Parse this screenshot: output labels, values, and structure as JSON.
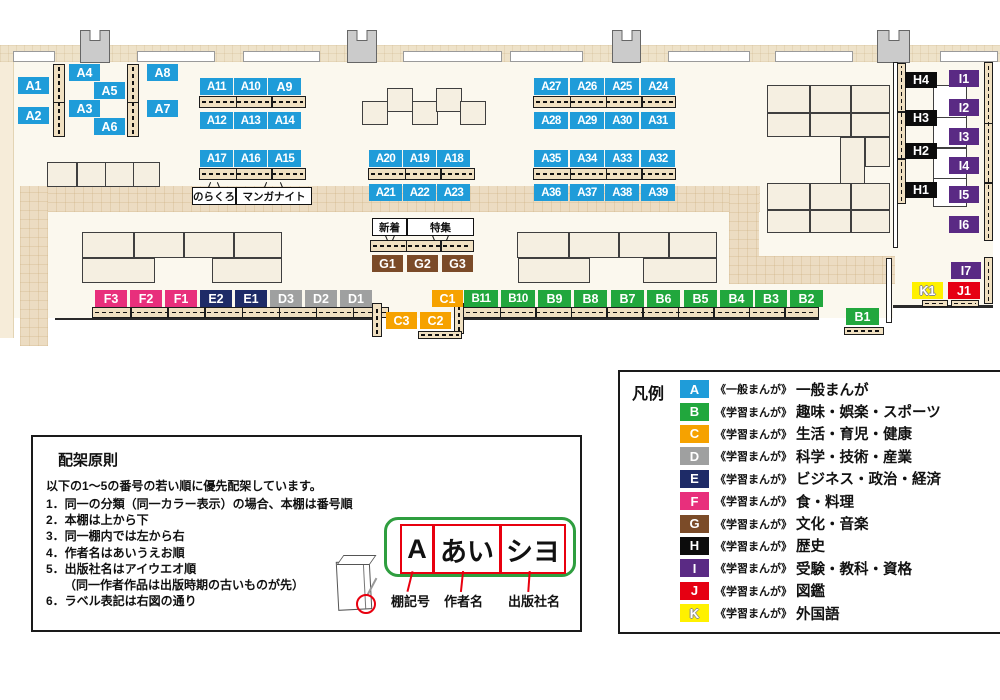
{
  "map": {
    "marker_colors": {
      "A": "#1f9cd9",
      "B": "#21a73d",
      "C": "#f6a200",
      "D": "#9fa0a0",
      "E": "#1e2b67",
      "F": "#e82f7c",
      "G": "#7b4b28",
      "H": "#0c0c0c",
      "I": "#5a2a84",
      "J": "#e60012",
      "K": "#fff100"
    },
    "markers": [
      {
        "code": "A1",
        "x": 18,
        "y": 77
      },
      {
        "code": "A2",
        "x": 18,
        "y": 107
      },
      {
        "code": "A4",
        "x": 69,
        "y": 64
      },
      {
        "code": "A3",
        "x": 69,
        "y": 100
      },
      {
        "code": "A5",
        "x": 94,
        "y": 82
      },
      {
        "code": "A6",
        "x": 94,
        "y": 118
      },
      {
        "code": "A8",
        "x": 147,
        "y": 64
      },
      {
        "code": "A7",
        "x": 147,
        "y": 100
      },
      {
        "code": "A11",
        "x": 200,
        "y": 78,
        "w": 33
      },
      {
        "code": "A10",
        "x": 234,
        "y": 78,
        "w": 33
      },
      {
        "code": "A9",
        "x": 268,
        "y": 78,
        "w": 33
      },
      {
        "code": "A12",
        "x": 200,
        "y": 112,
        "w": 33
      },
      {
        "code": "A13",
        "x": 234,
        "y": 112,
        "w": 33
      },
      {
        "code": "A14",
        "x": 268,
        "y": 112,
        "w": 33
      },
      {
        "code": "A17",
        "x": 200,
        "y": 150,
        "w": 33
      },
      {
        "code": "A16",
        "x": 234,
        "y": 150,
        "w": 33
      },
      {
        "code": "A15",
        "x": 268,
        "y": 150,
        "w": 33
      },
      {
        "code": "A20",
        "x": 369,
        "y": 150,
        "w": 33
      },
      {
        "code": "A19",
        "x": 403,
        "y": 150,
        "w": 33
      },
      {
        "code": "A18",
        "x": 437,
        "y": 150,
        "w": 33
      },
      {
        "code": "A21",
        "x": 369,
        "y": 184,
        "w": 33
      },
      {
        "code": "A22",
        "x": 403,
        "y": 184,
        "w": 33
      },
      {
        "code": "A23",
        "x": 437,
        "y": 184,
        "w": 33
      },
      {
        "code": "A27",
        "x": 534,
        "y": 78,
        "w": 34
      },
      {
        "code": "A26",
        "x": 570,
        "y": 78,
        "w": 34
      },
      {
        "code": "A25",
        "x": 605,
        "y": 78,
        "w": 34
      },
      {
        "code": "A24",
        "x": 641,
        "y": 78,
        "w": 34
      },
      {
        "code": "A28",
        "x": 534,
        "y": 112,
        "w": 34
      },
      {
        "code": "A29",
        "x": 570,
        "y": 112,
        "w": 34
      },
      {
        "code": "A30",
        "x": 605,
        "y": 112,
        "w": 34
      },
      {
        "code": "A31",
        "x": 641,
        "y": 112,
        "w": 34
      },
      {
        "code": "A35",
        "x": 534,
        "y": 150,
        "w": 34
      },
      {
        "code": "A34",
        "x": 570,
        "y": 150,
        "w": 34
      },
      {
        "code": "A33",
        "x": 605,
        "y": 150,
        "w": 34
      },
      {
        "code": "A32",
        "x": 641,
        "y": 150,
        "w": 34
      },
      {
        "code": "A36",
        "x": 534,
        "y": 184,
        "w": 34
      },
      {
        "code": "A37",
        "x": 570,
        "y": 184,
        "w": 34
      },
      {
        "code": "A38",
        "x": 605,
        "y": 184,
        "w": 34
      },
      {
        "code": "A39",
        "x": 641,
        "y": 184,
        "w": 34
      },
      {
        "code": "G1",
        "x": 372,
        "y": 255
      },
      {
        "code": "G2",
        "x": 407,
        "y": 255
      },
      {
        "code": "G3",
        "x": 442,
        "y": 255
      },
      {
        "code": "F3",
        "x": 95,
        "y": 290,
        "w": 32
      },
      {
        "code": "F2",
        "x": 130,
        "y": 290,
        "w": 32
      },
      {
        "code": "F1",
        "x": 165,
        "y": 290,
        "w": 32
      },
      {
        "code": "E2",
        "x": 200,
        "y": 290,
        "w": 32
      },
      {
        "code": "E1",
        "x": 235,
        "y": 290,
        "w": 32
      },
      {
        "code": "D3",
        "x": 270,
        "y": 290,
        "w": 32
      },
      {
        "code": "D2",
        "x": 305,
        "y": 290,
        "w": 32
      },
      {
        "code": "D1",
        "x": 340,
        "y": 290,
        "w": 32
      },
      {
        "code": "C1",
        "x": 432,
        "y": 290
      },
      {
        "code": "C3",
        "x": 386,
        "y": 312
      },
      {
        "code": "C2",
        "x": 420,
        "y": 312
      },
      {
        "code": "B11",
        "x": 464,
        "y": 290,
        "w": 34
      },
      {
        "code": "B10",
        "x": 501,
        "y": 290,
        "w": 34
      },
      {
        "code": "B9",
        "x": 538,
        "y": 290,
        "w": 33
      },
      {
        "code": "B8",
        "x": 574,
        "y": 290,
        "w": 33
      },
      {
        "code": "B7",
        "x": 611,
        "y": 290,
        "w": 33
      },
      {
        "code": "B6",
        "x": 647,
        "y": 290,
        "w": 33
      },
      {
        "code": "B5",
        "x": 684,
        "y": 290,
        "w": 33
      },
      {
        "code": "B4",
        "x": 720,
        "y": 290,
        "w": 33
      },
      {
        "code": "B3",
        "x": 755,
        "y": 290,
        "w": 32
      },
      {
        "code": "B2",
        "x": 790,
        "y": 290,
        "w": 33
      },
      {
        "code": "B1",
        "x": 846,
        "y": 308,
        "w": 33
      },
      {
        "code": "H4",
        "x": 905,
        "y": 72,
        "w": 32,
        "h": 16
      },
      {
        "code": "H3",
        "x": 905,
        "y": 110,
        "w": 32,
        "h": 16
      },
      {
        "code": "H2",
        "x": 905,
        "y": 143,
        "w": 32,
        "h": 16
      },
      {
        "code": "H1",
        "x": 905,
        "y": 182,
        "w": 32,
        "h": 16
      },
      {
        "code": "I1",
        "x": 949,
        "y": 70,
        "w": 30
      },
      {
        "code": "I2",
        "x": 949,
        "y": 99,
        "w": 30
      },
      {
        "code": "I3",
        "x": 949,
        "y": 128,
        "w": 30
      },
      {
        "code": "I4",
        "x": 949,
        "y": 157,
        "w": 30
      },
      {
        "code": "I5",
        "x": 949,
        "y": 186,
        "w": 30
      },
      {
        "code": "I6",
        "x": 949,
        "y": 216,
        "w": 30
      },
      {
        "code": "I7",
        "x": 951,
        "y": 262,
        "w": 30
      },
      {
        "code": "K1",
        "x": 912,
        "y": 282
      },
      {
        "code": "J1",
        "x": 948,
        "y": 282,
        "w": 32
      }
    ],
    "callouts": [
      {
        "text": "のらくろ",
        "x": 192,
        "y": 187,
        "w": 42,
        "h": 16,
        "tick": "up"
      },
      {
        "text": "マンガナイト",
        "x": 236,
        "y": 187,
        "w": 74,
        "h": 16,
        "tick": "up"
      },
      {
        "text": "新着",
        "x": 372,
        "y": 218,
        "w": 33,
        "h": 16,
        "tick": "down"
      },
      {
        "text": "特集",
        "x": 407,
        "y": 218,
        "w": 65,
        "h": 16,
        "tick": "down"
      }
    ]
  },
  "legend": {
    "title": "凡例",
    "entries": [
      {
        "code": "A",
        "type": "《一般まんが》",
        "category": "一般まんが",
        "color": "#1f9cd9"
      },
      {
        "code": "B",
        "type": "《学習まんが》",
        "category": "趣味・娯楽・スポーツ",
        "color": "#21a73d"
      },
      {
        "code": "C",
        "type": "《学習まんが》",
        "category": "生活・育児・健康",
        "color": "#f6a200"
      },
      {
        "code": "D",
        "type": "《学習まんが》",
        "category": "科学・技術・産業",
        "color": "#9fa0a0"
      },
      {
        "code": "E",
        "type": "《学習まんが》",
        "category": "ビジネス・政治・経済",
        "color": "#1e2b67"
      },
      {
        "code": "F",
        "type": "《学習まんが》",
        "category": "食・料理",
        "color": "#e82f7c"
      },
      {
        "code": "G",
        "type": "《学習まんが》",
        "category": "文化・音楽",
        "color": "#7b4b28"
      },
      {
        "code": "H",
        "type": "《学習まんが》",
        "category": "歴史",
        "color": "#0c0c0c"
      },
      {
        "code": "I",
        "type": "《学習まんが》",
        "category": "受験・教科・資格",
        "color": "#5a2a84"
      },
      {
        "code": "J",
        "type": "《学習まんが》",
        "category": "図鑑",
        "color": "#e60012"
      },
      {
        "code": "K",
        "type": "《学習まんが》",
        "category": "外国語",
        "color": "#fff100"
      }
    ]
  },
  "rules_box": {
    "title": "配架原則",
    "intro": "以下の1～5の番号の若い順に優先配架しています。",
    "items": [
      "1．同一の分類（同一カラー表示）の場合、本棚は番号順",
      "2．本棚は上から下",
      "3．同一棚内では左から右",
      "4．作者名はあいうえお順",
      "5．出版社名はアイウエオ順",
      "　　（同一作者作品は出版時期の古いものが先）",
      "6．ラベル表記は右図の通り"
    ],
    "label_diagram": {
      "segments": [
        "A",
        "あい",
        "シヨ"
      ],
      "captions": [
        "棚記号",
        "作者名",
        "出版社名"
      ]
    }
  }
}
